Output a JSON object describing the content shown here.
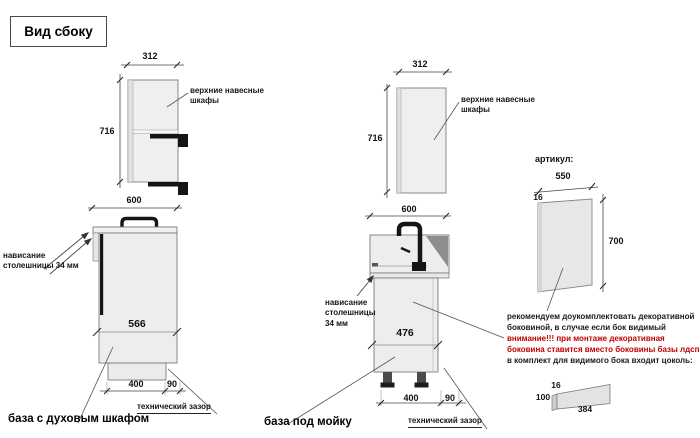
{
  "title": "Вид сбоку",
  "colors": {
    "warning_red": "#c00000",
    "drawing_outline": "#7a7a7a",
    "cabinet_fill": "#ededed",
    "sink_shading": "#8d8d8d",
    "hardware_black": "#151515"
  },
  "left_unit": {
    "upper_width": "312",
    "upper_height": "716",
    "upper_label": "верхние навесные шкафы",
    "base_width": "600",
    "base_depth": "566",
    "overhang_label": "нависание столешницы 34 мм",
    "plinth_depth": "400",
    "tech_gap": "90",
    "tech_gap_label": "технический зазор",
    "caption": "база с духовым шкафом"
  },
  "middle_unit": {
    "upper_width": "312",
    "upper_height": "716",
    "upper_label": "верхние навесные шкафы",
    "base_width": "600",
    "base_depth": "476",
    "overhang_label": "нависание столешницы 34 мм",
    "plinth_depth": "400",
    "tech_gap": "90",
    "tech_gap_label": "технический зазор",
    "caption": "база под мойку"
  },
  "side_panel": {
    "heading": "артикул:",
    "width": "550",
    "thickness": "16",
    "height": "700"
  },
  "notes": {
    "lines": [
      {
        "text": "рекомендуем доукомплектовать декоративной",
        "style": "normal"
      },
      {
        "text": "боковиной, в случае если бок видимый",
        "style": "normal"
      },
      {
        "text": "внимание!!! при монтаже декоративная",
        "style": "warning"
      },
      {
        "text": "боковина ставится вместо боковины базы лдсп",
        "style": "warning"
      },
      {
        "text": "в комплект для видимого бока входит цоколь:",
        "style": "normal"
      }
    ]
  },
  "plinth_part": {
    "thickness": "16",
    "height": "100",
    "length": "384"
  }
}
